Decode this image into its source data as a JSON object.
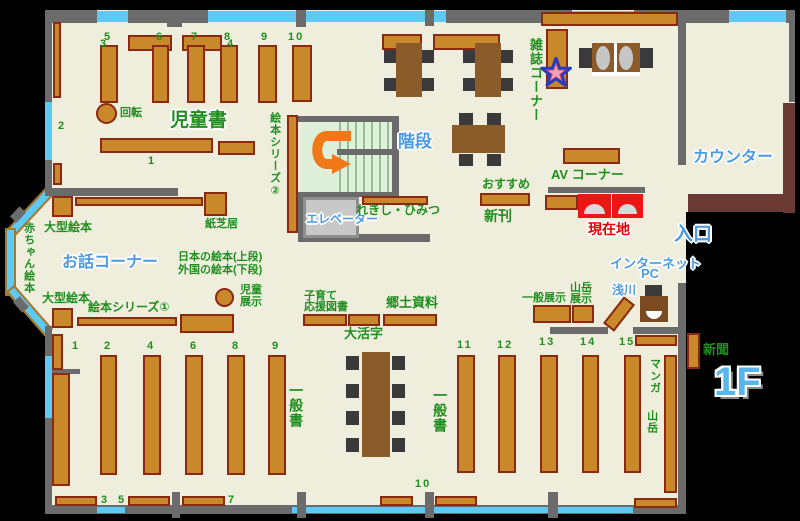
{
  "floor_label": "1F",
  "labels": {
    "n3": "3",
    "n4": "4",
    "n5": "5",
    "n6": "6",
    "n7": "7",
    "n8": "8",
    "n9": "9",
    "n10": "10",
    "n2": "2",
    "n1": "1",
    "kaiten": "回転",
    "jidosho": "児童書",
    "kamishibai": "紙芝居",
    "ogata": "大型絵本",
    "ohanashi": "お話コーナー",
    "akachan": "赤ちゃん絵本",
    "ehon2": "絵本シリーズ②",
    "ehon1": "絵本シリーズ①",
    "nihon": "日本の絵本(上段)",
    "gaikoku": "外国の絵本(下段)",
    "jido": "児童",
    "tenji": "展示",
    "kaidan": "階段",
    "elevator": "エレベーター",
    "rekishi": "れきし・ひみつ",
    "osusume": "おすすめ",
    "shinkan": "新刊",
    "zasshi": "雑誌コーナー",
    "av": "AV コーナー",
    "genzaichi": "現在地",
    "counter": "カウンター",
    "iriguchi": "入口",
    "internet": "インターネット",
    "pc": "PC",
    "asakawa": "浅川",
    "sangaku": "山岳",
    "ippantenji": "一般展示",
    "kosodate1": "子育て",
    "kosodate2": "応援図書",
    "kyodo": "郷土資料",
    "daikatsuji": "大活字",
    "ippansho": "一般書",
    "manga": "マンガ",
    "shinbun": "新聞",
    "b1": "1",
    "b2": "2",
    "b4": "4",
    "b6": "6",
    "b8": "8",
    "b9": "9",
    "b11": "11",
    "b12": "12",
    "b13": "13",
    "b14": "14",
    "b15": "15",
    "b3": "3",
    "b5": "5",
    "b7": "7",
    "b10": "10",
    "floor": "1F"
  },
  "colors": {
    "floor": "#efeedd",
    "wall": "#6b6b6b",
    "window": "#5ec9f2",
    "shelf": "#c9892b",
    "shelf_border": "#8a2a12",
    "table": "#8b5c2a",
    "chair": "#3a3a3a",
    "counter": "#6b3a35",
    "stairs": "#def0da",
    "elevator": "#c8c8c8",
    "security_gate": "#ee1515",
    "arrow": "#f07818",
    "text_green": "#1f8e1f",
    "text_blue": "#4d9be0",
    "text_red": "#e60000",
    "outside": "#000000"
  }
}
